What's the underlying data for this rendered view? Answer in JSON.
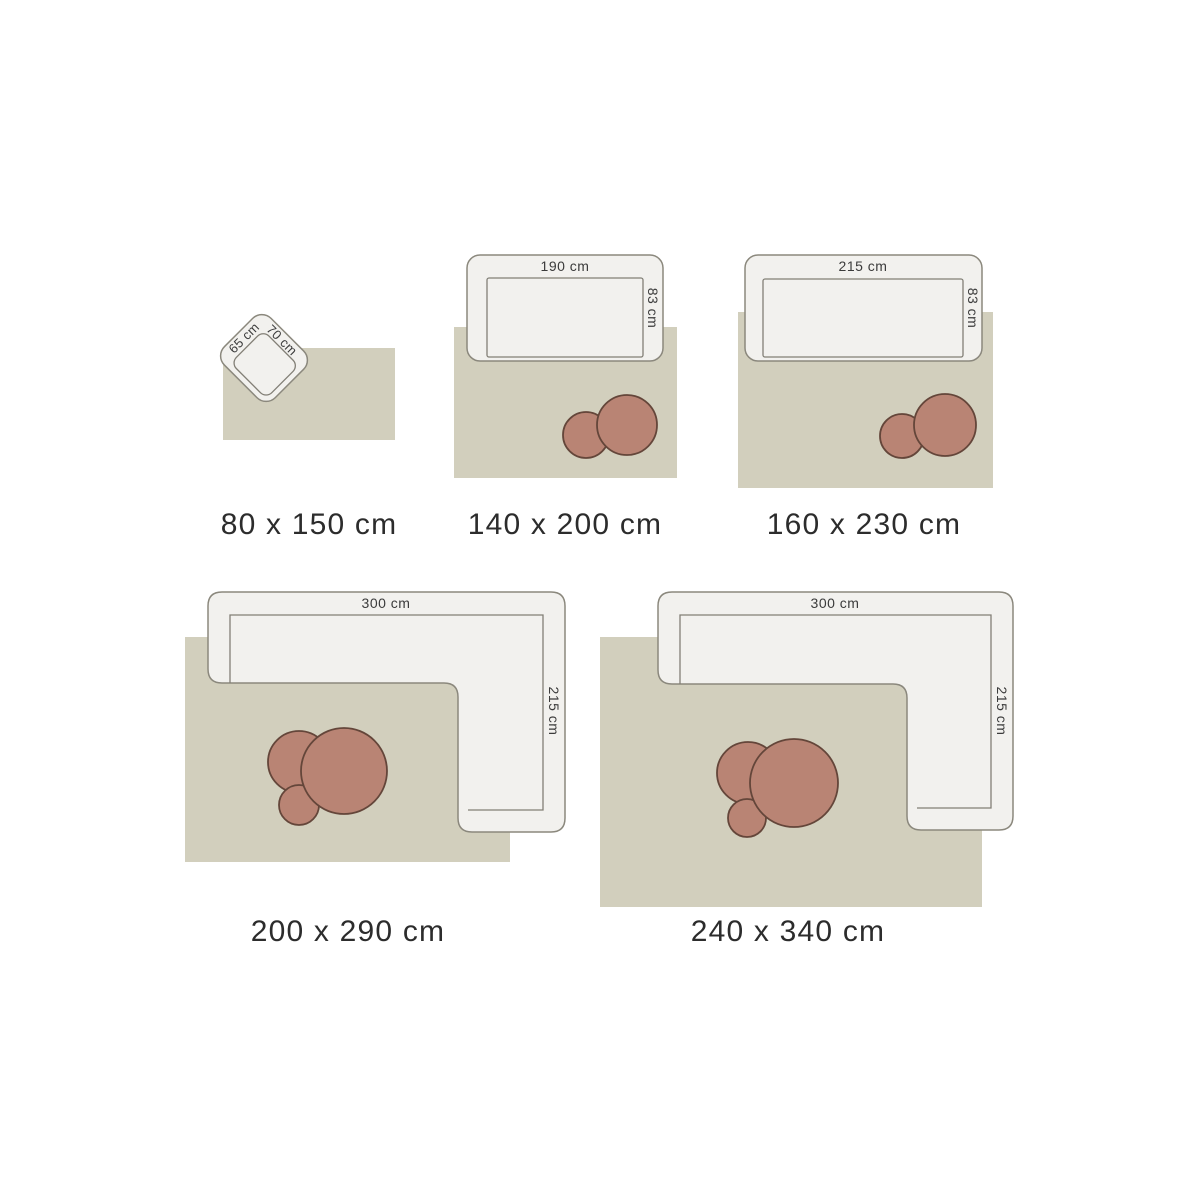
{
  "title": "Rug size guide",
  "colors": {
    "background": "#ffffff",
    "rug": "#d2cfbd",
    "sofa_fill": "#f2f1ee",
    "sofa_border": "#8b887d",
    "table_fill": "#b98474",
    "table_border": "#64463a",
    "size_label_text": "#2c2c2c",
    "dimension_text": "#3b3b3b"
  },
  "diagrams": [
    {
      "size_label": "80 x 150 cm",
      "furniture": "armchair",
      "width_label": "65 cm",
      "depth_label": "70 cm",
      "coffee_tables": 0
    },
    {
      "size_label": "140 x 200 cm",
      "furniture": "sofa",
      "width_label": "190 cm",
      "depth_label": "83 cm",
      "coffee_tables": 2
    },
    {
      "size_label": "160 x 230 cm",
      "furniture": "sofa",
      "width_label": "215 cm",
      "depth_label": "83 cm",
      "coffee_tables": 2
    },
    {
      "size_label": "200 x 290 cm",
      "furniture": "sectional-sofa",
      "width_label": "300 cm",
      "depth_label": "215 cm",
      "coffee_tables": 3
    },
    {
      "size_label": "240 x 340 cm",
      "furniture": "sectional-sofa",
      "width_label": "300 cm",
      "depth_label": "215 cm",
      "coffee_tables": 3
    }
  ]
}
